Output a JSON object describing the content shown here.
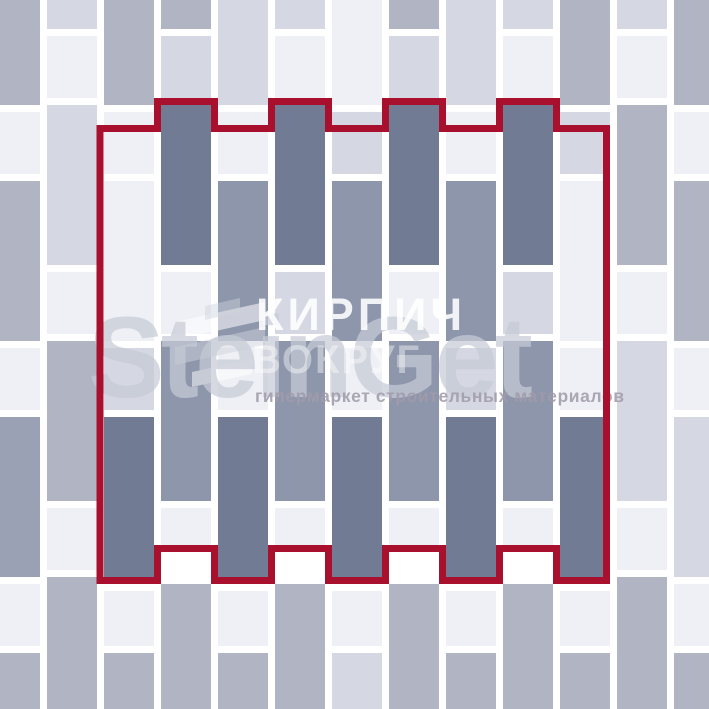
{
  "watermark": {
    "line1": "КИРПИЧ",
    "line2": "ВОКРУГ",
    "brand": "SteinGet",
    "tagline": "гипермаркет строительных материалов",
    "brand_color": "#c6cbd6",
    "text_color": "#ffffff",
    "tagline_color": "#a09baa"
  },
  "pattern": {
    "description": "vertical running-bond paving layout with highlighted pattern unit",
    "background": "#ffffff",
    "joint_color": "#ffffff",
    "brick_width": 50,
    "column_pitch": 57,
    "joint_gap": 7,
    "outline_color": "#a8102e",
    "outline_thickness": 7,
    "colors": [
      "#ffffff",
      "#eef0f5",
      "#d5d8e2",
      "#b1b4c3",
      "#9aa1b5",
      "#8e96ac",
      "#717b94"
    ],
    "color_names": [
      "joint-white",
      "near-white",
      "light-gray",
      "medium-gray",
      "gray-blue",
      "slate-medium",
      "slate-dark"
    ],
    "columns": [
      {
        "x": -10,
        "bricks": [
          [
            0,
            105,
            3
          ],
          [
            112,
            62,
            1
          ],
          [
            181,
            160,
            3
          ],
          [
            348,
            62,
            1
          ],
          [
            417,
            160,
            4
          ],
          [
            584,
            62,
            1
          ],
          [
            653,
            56,
            3
          ]
        ]
      },
      {
        "x": 47,
        "bricks": [
          [
            0,
            29,
            2
          ],
          [
            36,
            62,
            1
          ],
          [
            105,
            160,
            2
          ],
          [
            272,
            62,
            1
          ],
          [
            341,
            160,
            3
          ],
          [
            508,
            62,
            1
          ],
          [
            577,
            132,
            3
          ]
        ]
      },
      {
        "x": 104,
        "bricks": [
          [
            0,
            105,
            3
          ],
          [
            112,
            62,
            1
          ],
          [
            181,
            160,
            1
          ],
          [
            348,
            62,
            2
          ],
          [
            417,
            160,
            6
          ],
          [
            591,
            55,
            1
          ],
          [
            653,
            56,
            3
          ]
        ]
      },
      {
        "x": 161,
        "bricks": [
          [
            0,
            29,
            3
          ],
          [
            36,
            62,
            2
          ],
          [
            105,
            160,
            6
          ],
          [
            272,
            62,
            1
          ],
          [
            341,
            160,
            5
          ],
          [
            508,
            37,
            1
          ],
          [
            584,
            125,
            3
          ]
        ]
      },
      {
        "x": 218,
        "bricks": [
          [
            0,
            105,
            2
          ],
          [
            112,
            62,
            1
          ],
          [
            181,
            160,
            5
          ],
          [
            348,
            62,
            1
          ],
          [
            417,
            160,
            6
          ],
          [
            591,
            55,
            1
          ],
          [
            653,
            56,
            3
          ]
        ]
      },
      {
        "x": 275,
        "bricks": [
          [
            0,
            29,
            2
          ],
          [
            36,
            62,
            1
          ],
          [
            105,
            160,
            6
          ],
          [
            272,
            62,
            2
          ],
          [
            341,
            160,
            5
          ],
          [
            508,
            37,
            1
          ],
          [
            584,
            125,
            3
          ]
        ]
      },
      {
        "x": 332,
        "bricks": [
          [
            0,
            105,
            1
          ],
          [
            112,
            62,
            2
          ],
          [
            181,
            160,
            5
          ],
          [
            348,
            62,
            1
          ],
          [
            417,
            160,
            6
          ],
          [
            591,
            55,
            1
          ],
          [
            653,
            56,
            2
          ]
        ]
      },
      {
        "x": 389,
        "bricks": [
          [
            0,
            29,
            3
          ],
          [
            36,
            62,
            2
          ],
          [
            105,
            160,
            6
          ],
          [
            272,
            62,
            1
          ],
          [
            341,
            160,
            5
          ],
          [
            508,
            37,
            1
          ],
          [
            584,
            125,
            3
          ]
        ]
      },
      {
        "x": 446,
        "bricks": [
          [
            0,
            105,
            2
          ],
          [
            112,
            62,
            1
          ],
          [
            181,
            160,
            5
          ],
          [
            348,
            62,
            2
          ],
          [
            417,
            160,
            6
          ],
          [
            591,
            55,
            1
          ],
          [
            653,
            56,
            3
          ]
        ]
      },
      {
        "x": 503,
        "bricks": [
          [
            0,
            29,
            2
          ],
          [
            36,
            62,
            1
          ],
          [
            105,
            160,
            6
          ],
          [
            272,
            62,
            2
          ],
          [
            341,
            160,
            5
          ],
          [
            508,
            37,
            1
          ],
          [
            584,
            125,
            3
          ]
        ]
      },
      {
        "x": 560,
        "bricks": [
          [
            0,
            105,
            3
          ],
          [
            112,
            62,
            2
          ],
          [
            181,
            160,
            1
          ],
          [
            348,
            62,
            1
          ],
          [
            417,
            160,
            6
          ],
          [
            591,
            55,
            1
          ],
          [
            653,
            56,
            3
          ]
        ]
      },
      {
        "x": 617,
        "bricks": [
          [
            0,
            29,
            2
          ],
          [
            36,
            62,
            1
          ],
          [
            105,
            160,
            3
          ],
          [
            272,
            62,
            1
          ],
          [
            341,
            160,
            2
          ],
          [
            508,
            62,
            1
          ],
          [
            577,
            132,
            3
          ]
        ]
      },
      {
        "x": 674,
        "bricks": [
          [
            0,
            105,
            3
          ],
          [
            112,
            62,
            1
          ],
          [
            181,
            160,
            3
          ],
          [
            348,
            62,
            1
          ],
          [
            417,
            160,
            2
          ],
          [
            584,
            62,
            1
          ],
          [
            653,
            56,
            3
          ]
        ]
      }
    ],
    "region_outline_points": [
      [
        100,
        128.5
      ],
      [
        157.5,
        128.5
      ],
      [
        157.5,
        101.5
      ],
      [
        214.5,
        101.5
      ],
      [
        214.5,
        128.5
      ],
      [
        271.5,
        128.5
      ],
      [
        271.5,
        101.5
      ],
      [
        328.5,
        101.5
      ],
      [
        328.5,
        128.5
      ],
      [
        385.5,
        128.5
      ],
      [
        385.5,
        101.5
      ],
      [
        442.5,
        101.5
      ],
      [
        442.5,
        128.5
      ],
      [
        499.5,
        128.5
      ],
      [
        499.5,
        101.5
      ],
      [
        556.5,
        101.5
      ],
      [
        556.5,
        128.5
      ],
      [
        606.5,
        128.5
      ],
      [
        606.5,
        580.5
      ],
      [
        556.5,
        580.5
      ],
      [
        556.5,
        548.5
      ],
      [
        499.5,
        548.5
      ],
      [
        499.5,
        580.5
      ],
      [
        442.5,
        580.5
      ],
      [
        442.5,
        548.5
      ],
      [
        385.5,
        548.5
      ],
      [
        385.5,
        580.5
      ],
      [
        328.5,
        580.5
      ],
      [
        328.5,
        548.5
      ],
      [
        271.5,
        548.5
      ],
      [
        271.5,
        580.5
      ],
      [
        214.5,
        580.5
      ],
      [
        214.5,
        548.5
      ],
      [
        157.5,
        548.5
      ],
      [
        157.5,
        580.5
      ],
      [
        100,
        580.5
      ]
    ]
  }
}
